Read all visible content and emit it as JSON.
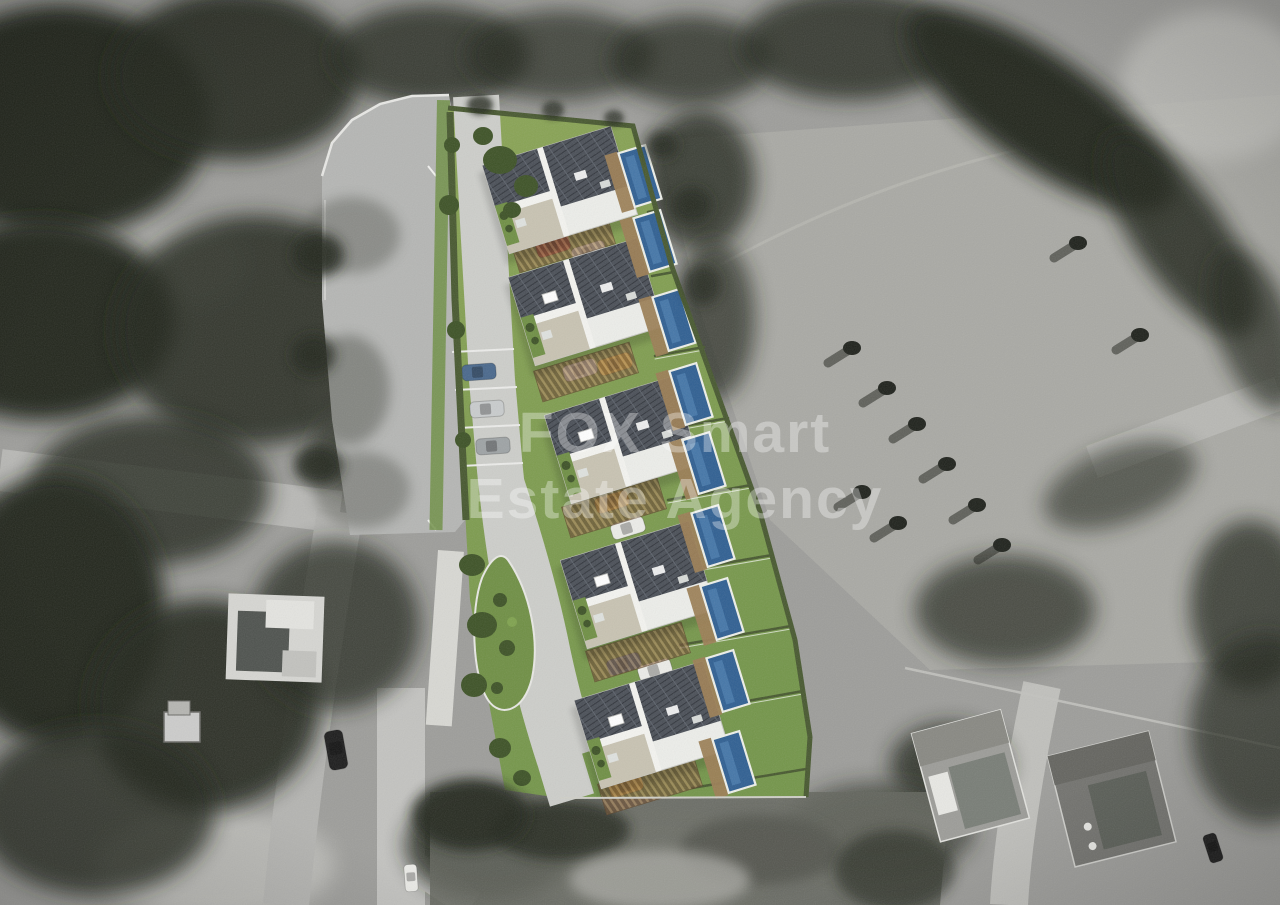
{
  "watermark": {
    "line1": "FOX Smart",
    "line2": "Estate Agency"
  },
  "scene": {
    "type": "aerial-photo-with-architectural-render",
    "site": {
      "house_blocks": 5,
      "pools": 9,
      "pergolas": 5,
      "parking_bays": 3,
      "landscaped_island": 1
    },
    "render_cars": [
      "blue",
      "silver",
      "gray",
      "blue",
      "red",
      "white",
      "white",
      "yellow",
      "yellow",
      "white",
      "blue",
      "white",
      "yellow"
    ],
    "photo_cars": [
      "black",
      "white",
      "dark-gray"
    ]
  },
  "colors": {
    "lawn": "#82a050",
    "lawn_dark": "#6f8f44",
    "hedge": "#47582f",
    "shrub": "#3d5226",
    "pool_water": "#2f5f92",
    "pool_deck": "#9b7d54",
    "wall": "#edeeea",
    "roof_beige": "#c8c3b2",
    "pv_panel": "#4a4f57",
    "road_render": "#cdceca",
    "paved": "#b5b6b4",
    "path": "#d8d8d3",
    "pergola": "#6b4e33",
    "pergola_slat": "#a8865c",
    "photo_base": "#9d9d9a",
    "field": "#a9a9a4",
    "photo_dark": "#23251f",
    "photo_mid": "#55574f",
    "photo_light": "#c2c2be",
    "car_red": "#b23a2e",
    "car_yellow": "#e3b53c",
    "car_blue": "#49688c",
    "car_silver": "#c9cccd",
    "car_white": "#ecece8",
    "car_black": "#1c1c1c",
    "watermark": "#ffffff"
  }
}
